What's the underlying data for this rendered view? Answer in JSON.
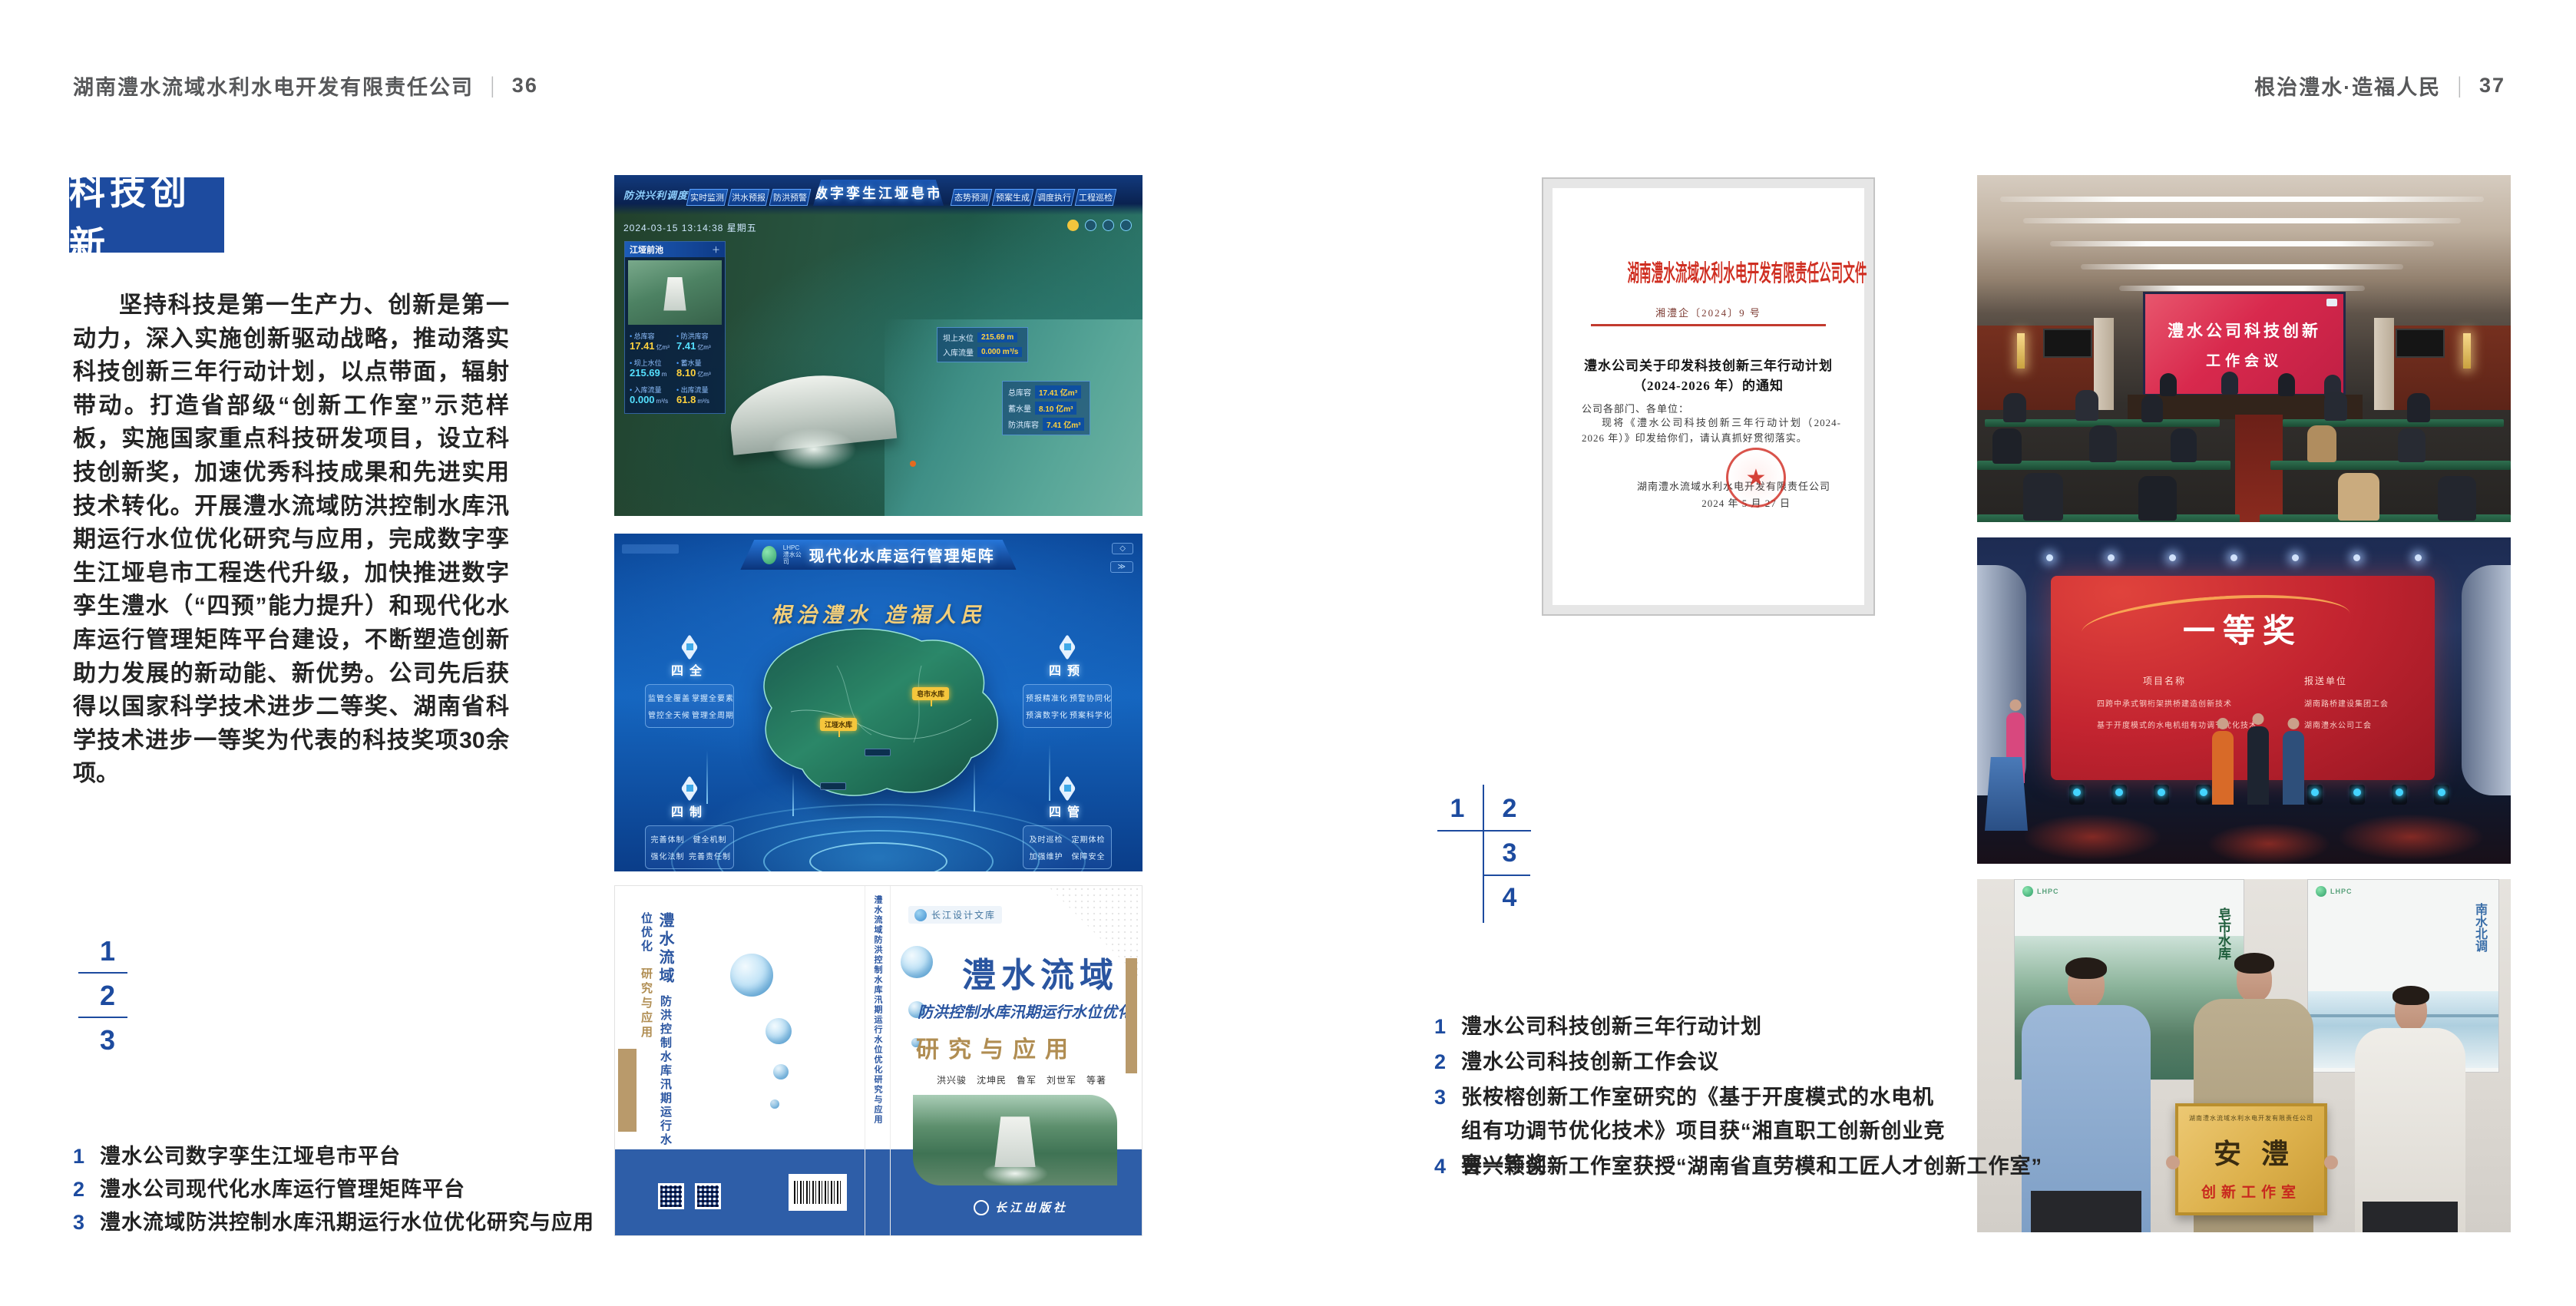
{
  "page": {
    "header_left": {
      "company": "湖南澧水流域水利水电开发有限责任公司",
      "divider": "|",
      "page_no": "36"
    },
    "header_right": {
      "slogan": "根治澧水·造福人民",
      "divider": "|",
      "page_no": "37"
    }
  },
  "colors": {
    "accent_blue": "#1d4b9f",
    "doc_red": "#cf2e21",
    "gold": "#f3cf7a"
  },
  "icons": {
    "seal_star": "★",
    "panel_plus": "＋",
    "close": "◇",
    "menu": "≫"
  },
  "left_page": {
    "section_title": "科技创新",
    "body": "坚持科技是第一生产力、创新是第一动力，深入实施创新驱动战略，推动落实科技创新三年行动计划，以点带面，辐射带动。打造省部级“创新工作室”示范样板，实施国家重点科技研发项目，设立科技创新奖，加速优秀科技成果和先进实用技术转化。开展澧水流域防洪控制水库汛期运行水位优化研究与应用，完成数字孪生江垭皂市工程迭代升级，加快推进数字孪生澧水（“四预”能力提升）和现代化水库运行管理矩阵平台建设，不断塑造创新助力发展的新动能、新优势。公司先后获得以国家科学技术进步二等奖、湖南省科学技术进步一等奖为代表的科技奖项30余项。",
    "figure_index": [
      "1",
      "2",
      "3"
    ],
    "captions": [
      {
        "no": "1",
        "text": "澧水公司数字孪生江垭皂市平台"
      },
      {
        "no": "2",
        "text": "澧水公司现代化水库运行管理矩阵平台"
      },
      {
        "no": "3",
        "text": "澧水流域防洪控制水库汛期运行水位优化研究与应用"
      }
    ]
  },
  "dashboard": {
    "corner_label": "防洪兴利调度",
    "title": "数字孪生江垭皂市",
    "tabs_left": [
      "实时监测",
      "洪水预报",
      "防洪预警"
    ],
    "tabs_right": [
      "态势预测",
      "预案生成",
      "调度执行",
      "工程巡检"
    ],
    "timestamp": "2024-03-15 13:14:38 星期五",
    "panel_title": "江垭前池",
    "stats": [
      {
        "label": "总库容",
        "value": "17.41",
        "unit": "亿m³"
      },
      {
        "label": "防洪库容",
        "value": "7.41",
        "unit": "亿m³"
      },
      {
        "label": "坝上水位",
        "value": "215.69",
        "unit": "m"
      },
      {
        "label": "蓄水量",
        "value": "8.10",
        "unit": "亿m³"
      },
      {
        "label": "入库流量",
        "value": "0.000",
        "unit": "m³/s"
      },
      {
        "label": "出库流量",
        "value": "61.8",
        "unit": "m³/s"
      }
    ],
    "float1": {
      "l1": "坝上水位",
      "v1": "215.69 m",
      "l2": "入库流量",
      "v2": "0.000 m³/s"
    },
    "float2": {
      "l1": "总库容",
      "v1": "17.41 亿m³",
      "l2": "蓄水量",
      "v2": "8.10 亿m³",
      "l3": "防洪库容",
      "v3": "7.41 亿m³"
    }
  },
  "matrix": {
    "logo_line1": "LHPC",
    "logo_line2": "澧水公司",
    "title": "现代化水库运行管理矩阵",
    "slogan": "根治澧水  造福人民",
    "groups": [
      {
        "name": "四全",
        "items": [
          "监管全覆盖",
          "掌握全要素",
          "管控全天候",
          "管理全周期"
        ]
      },
      {
        "name": "四预",
        "items": [
          "预报精准化",
          "预警协同化",
          "预演数字化",
          "预案科学化"
        ]
      },
      {
        "name": "四制",
        "items": [
          "完善体制",
          "健全机制",
          "强化法制",
          "完善责任制"
        ]
      },
      {
        "name": "四管",
        "items": [
          "及时巡检",
          "定期体检",
          "加强维护",
          "保障安全"
        ]
      }
    ],
    "tags": [
      "皂市水库",
      "江垭水库"
    ]
  },
  "book": {
    "series": "长江设计文库",
    "title1": "澧水流域",
    "title2": "防洪控制水库汛期运行水位优化",
    "title3": "研究与应用",
    "authors": "洪兴骏　沈坤民　鲁军　刘世军　等著",
    "publisher": "长江出版社",
    "spine": "澧水流域防洪控制水库汛期运行水位优化研究与应用"
  },
  "document": {
    "header": "湖南澧水流域水利水电开发有限责任公司文件",
    "doc_no": "湘澧企〔2024〕9 号",
    "title_line1": "澧水公司关于印发科技创新三年行动计划",
    "title_line2": "（2024-2026 年）的通知",
    "salutation": "公司各部门、各单位：",
    "body": "现将《澧水公司科技创新三年行动计划（2024-2026 年）》印发给你们，请认真抓好贯彻落实。",
    "signer": "湖南澧水流域水利水电开发有限责任公司",
    "date": "2024 年 5 月 27 日"
  },
  "meeting_photo": {
    "screen_line1": "澧水公司科技创新",
    "screen_line2": "工作会议"
  },
  "award_photo": {
    "title": "一等奖",
    "col1": "项目名称",
    "col2": "报送单位",
    "rows1": [
      "四跨中承式钢桁架拱桥建造创新技术",
      "基于开度模式的水电机组有功调节优化技术"
    ],
    "rows2": [
      "湖南路桥建设集团工会",
      "湖南澧水公司工会"
    ]
  },
  "group_photo": {
    "plaque_header": "湖南澧水流域水利水电开发有限责任公司",
    "plaque_main": "安澧",
    "plaque_sub": "创新工作室",
    "poster_left_text": "皂市水库",
    "poster_right_text": "南水北调"
  },
  "right_page": {
    "figure_index": [
      "1",
      "2",
      "3",
      "4"
    ],
    "captions": [
      {
        "no": "1",
        "text": "澧水公司科技创新三年行动计划"
      },
      {
        "no": "2",
        "text": "澧水公司科技创新工作会议"
      },
      {
        "no": "3",
        "text": "张桉榕创新工作室研究的《基于开度模式的水电机组有功调节优化技术》项目获“湘直职工创新创业竞赛一等奖”"
      },
      {
        "no": "4",
        "text": "曾兴颖创新工作室获授“湖南省直劳模和工匠人才创新工作室”"
      }
    ]
  }
}
